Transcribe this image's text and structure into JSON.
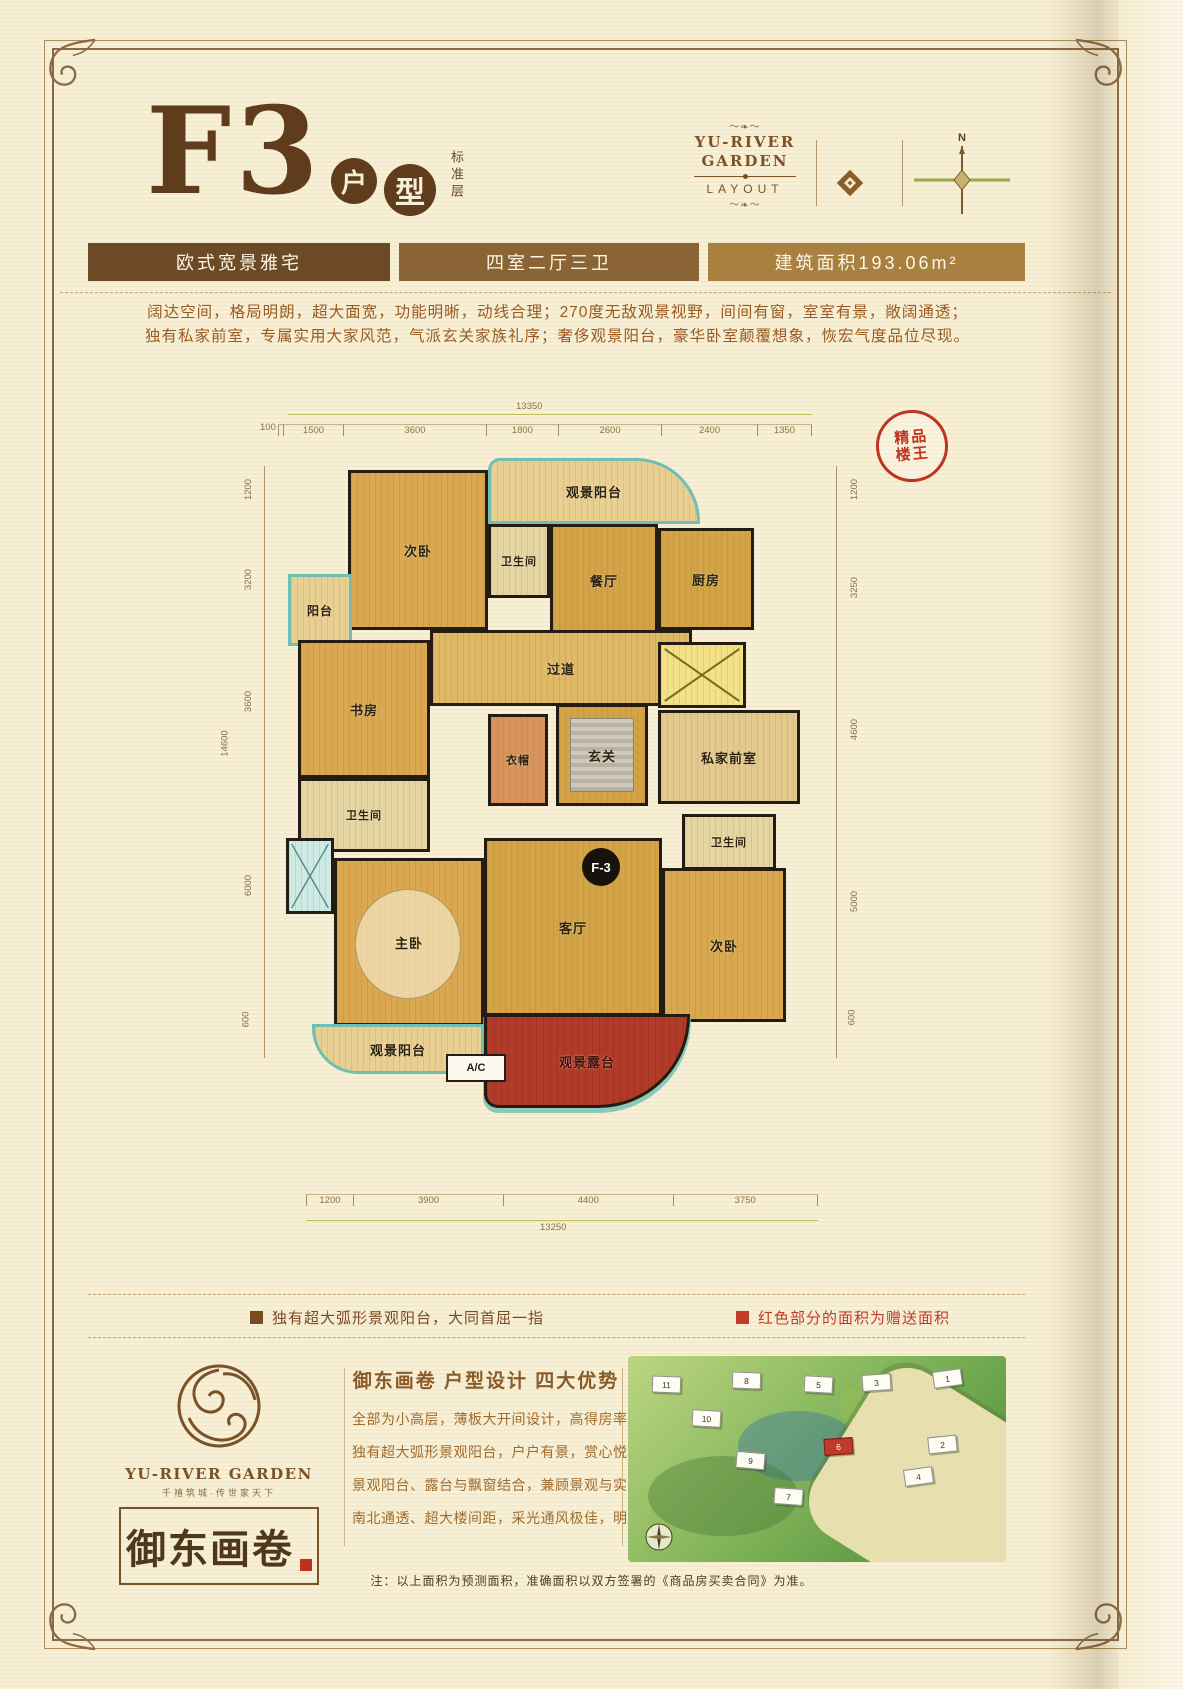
{
  "header": {
    "unit_code": "F3",
    "unit_type_char1": "户",
    "unit_type_char2": "型",
    "floor_note": "标准层",
    "brand_line1": "YU-RIVER",
    "brand_line2": "GARDEN",
    "brand_sub": "LAYOUT",
    "compass_label": "N"
  },
  "info_bars": [
    {
      "label": "欧式宽景雅宅",
      "color": "#6d4a26"
    },
    {
      "label": "四室二厅三卫",
      "color": "#8a6434"
    },
    {
      "label": "建筑面积193.06m²",
      "color": "#a8803f"
    }
  ],
  "description": {
    "line1": "阔达空间，格局明朗，超大面宽，功能明晰，动线合理；270度无敌观景视野，间间有窗，室室有景，敞阔通透；",
    "line2": "独有私家前室，专属实用大家风范，气派玄关家族礼序；奢侈观景阳台，豪华卧室颠覆想象，恢宏气度品位尽现。"
  },
  "seal": {
    "line1": "精品",
    "line2": "楼王"
  },
  "floor_plan": {
    "badge": "F-3",
    "ac_label": "A/C",
    "rooms": [
      {
        "label": "次卧"
      },
      {
        "label": "观景阳台"
      },
      {
        "label": "卫生间"
      },
      {
        "label": "餐厅"
      },
      {
        "label": "厨房"
      },
      {
        "label": "阳台"
      },
      {
        "label": "书房"
      },
      {
        "label": "过道"
      },
      {
        "label": "衣帽"
      },
      {
        "label": "玄关"
      },
      {
        "label": "私家前室"
      },
      {
        "label": "卫生间"
      },
      {
        "label": "卫生间"
      },
      {
        "label": "客厅"
      },
      {
        "label": "主卧"
      },
      {
        "label": "次卧"
      },
      {
        "label": "观景阳台"
      },
      {
        "label": "观景露台"
      }
    ],
    "dimensions": {
      "top_total": "13350",
      "top_segments": [
        "100",
        "1500",
        "3600",
        "1800",
        "2600",
        "2400",
        "1350"
      ],
      "bottom_total": "13250",
      "bottom_segments": [
        "1200",
        "3900",
        "4400",
        "3750"
      ],
      "left_total": "14600",
      "left_segments": [
        "1200",
        "3200",
        "3600",
        "6000",
        "600"
      ],
      "right_segments": [
        "1200",
        "3250",
        "4600",
        "5000",
        "600"
      ]
    }
  },
  "legend": {
    "item1": "独有超大弧形景观阳台，大同首屈一指",
    "item2": "红色部分的面积为赠送面积",
    "item1_color": "#7a4a22",
    "item2_color": "#c23b24"
  },
  "footer": {
    "brand_name": "YU-RIVER GARDEN",
    "brand_tagline": "千禧筑城·传世家天下",
    "calligraphy": "御东画卷",
    "adv_title": "御东画卷 户型设计 四大优势",
    "adv_line1": "全部为小高层，薄板大开间设计，高得房率",
    "adv_line2": "独有超大弧形景观阳台，户户有景，赏心悦目",
    "adv_line3": "景观阳台、露台与飘窗结合，兼顾景观与实用功能",
    "adv_line4": "南北通透、超大楼间距，采光通风极佳，明厨明卫",
    "note": "注：以上面积为预测面积，准确面积以双方签署的《商品房买卖合同》为准。"
  },
  "site_plan": {
    "buildings": [
      "1",
      "2",
      "3",
      "4",
      "5",
      "6",
      "7",
      "8",
      "9",
      "10",
      "11"
    ]
  }
}
